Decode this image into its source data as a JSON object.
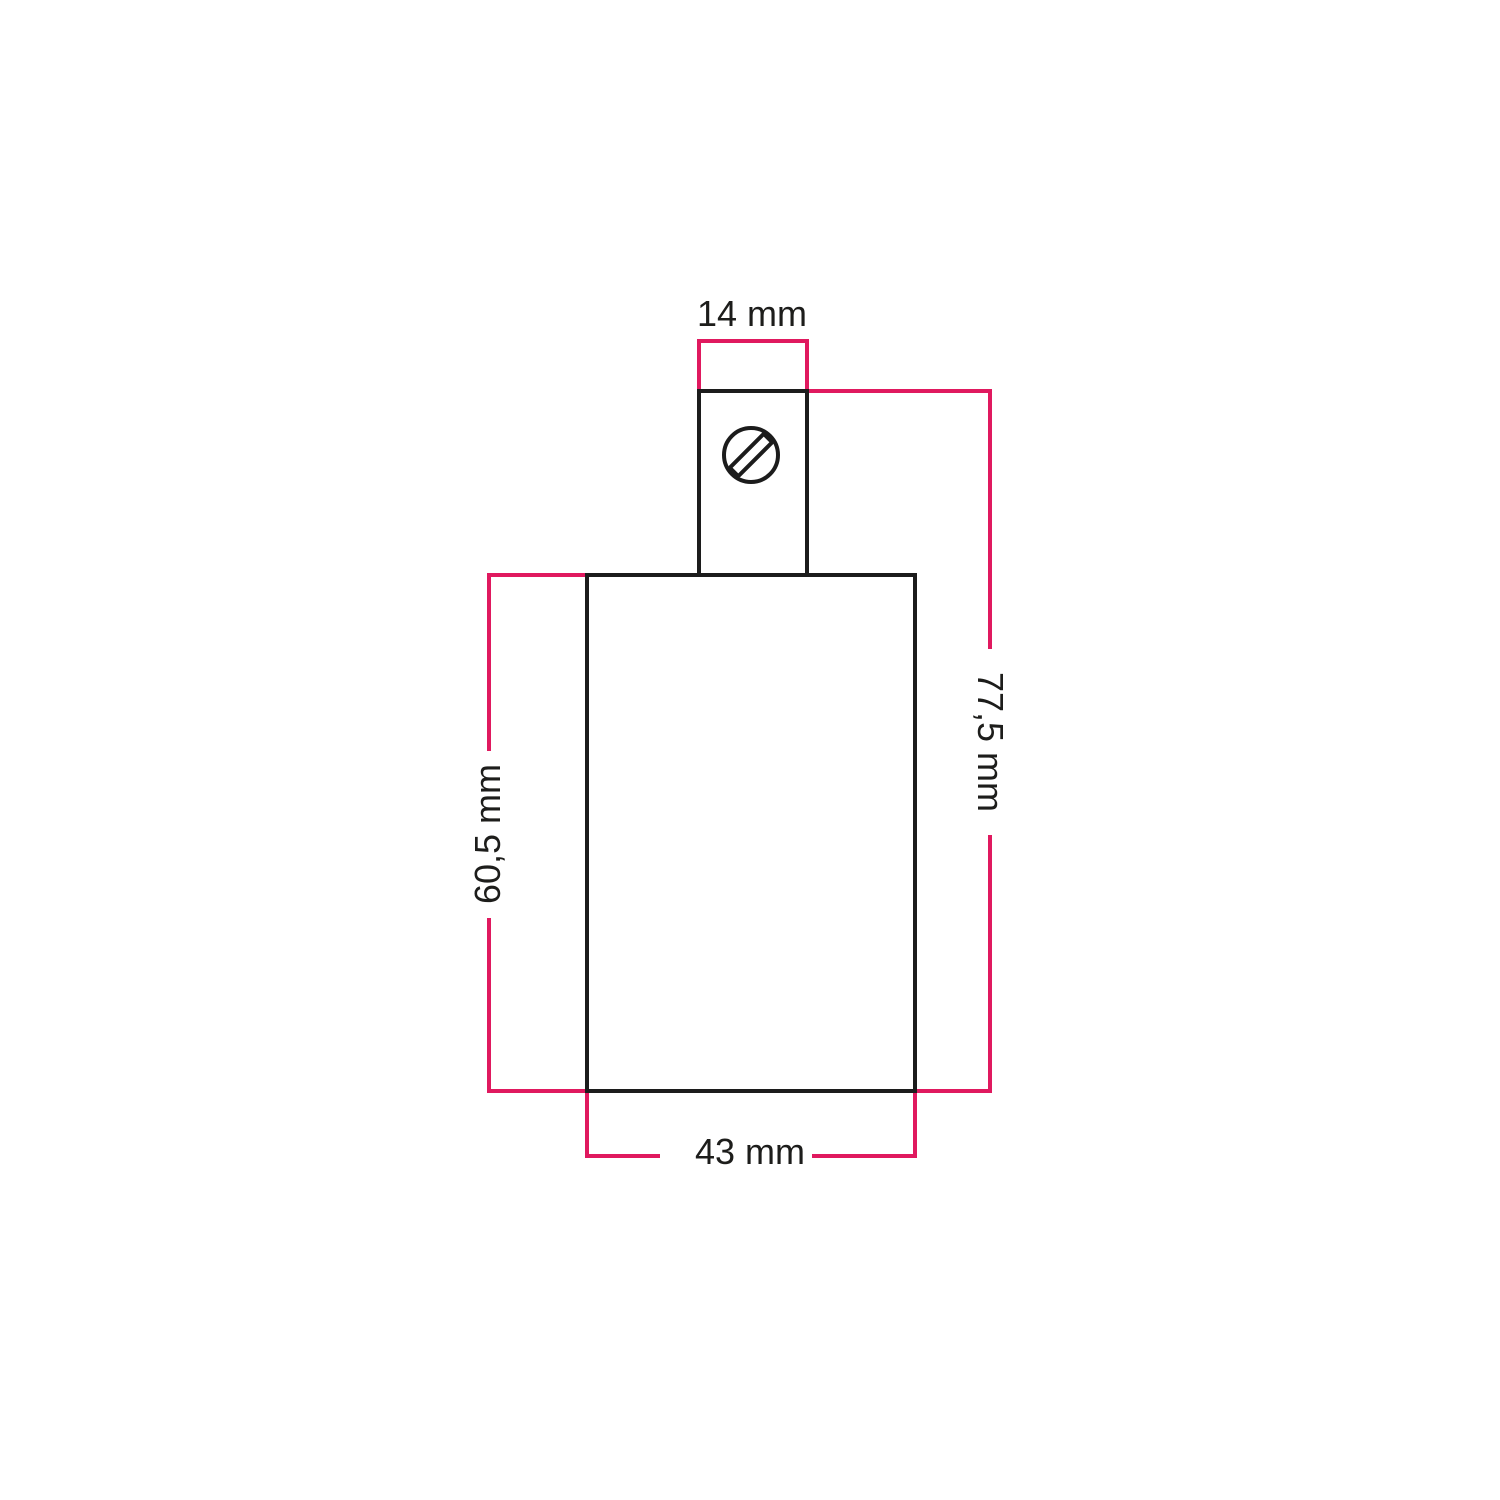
{
  "colors": {
    "dimension": "#e0195f",
    "outline": "#1c1c1c",
    "label": "#1d1d1b",
    "background": "#ffffff"
  },
  "diagram": {
    "type": "technical-dimension-drawing",
    "object": "cylindrical lamp holder with top screw cable clamp, front view",
    "unit": "mm",
    "dimensions": {
      "top_width": {
        "label": "14 mm",
        "value": 14,
        "unit": "mm",
        "measures": "cable clamp width"
      },
      "total_height": {
        "label": "77,5 mm",
        "value": 77.5,
        "unit": "mm",
        "measures": "total height"
      },
      "body_height": {
        "label": "60,5 mm",
        "value": 60.5,
        "unit": "mm",
        "measures": "body height"
      },
      "body_width": {
        "label": "43 mm",
        "value": 43,
        "unit": "mm",
        "measures": "body width"
      }
    }
  }
}
